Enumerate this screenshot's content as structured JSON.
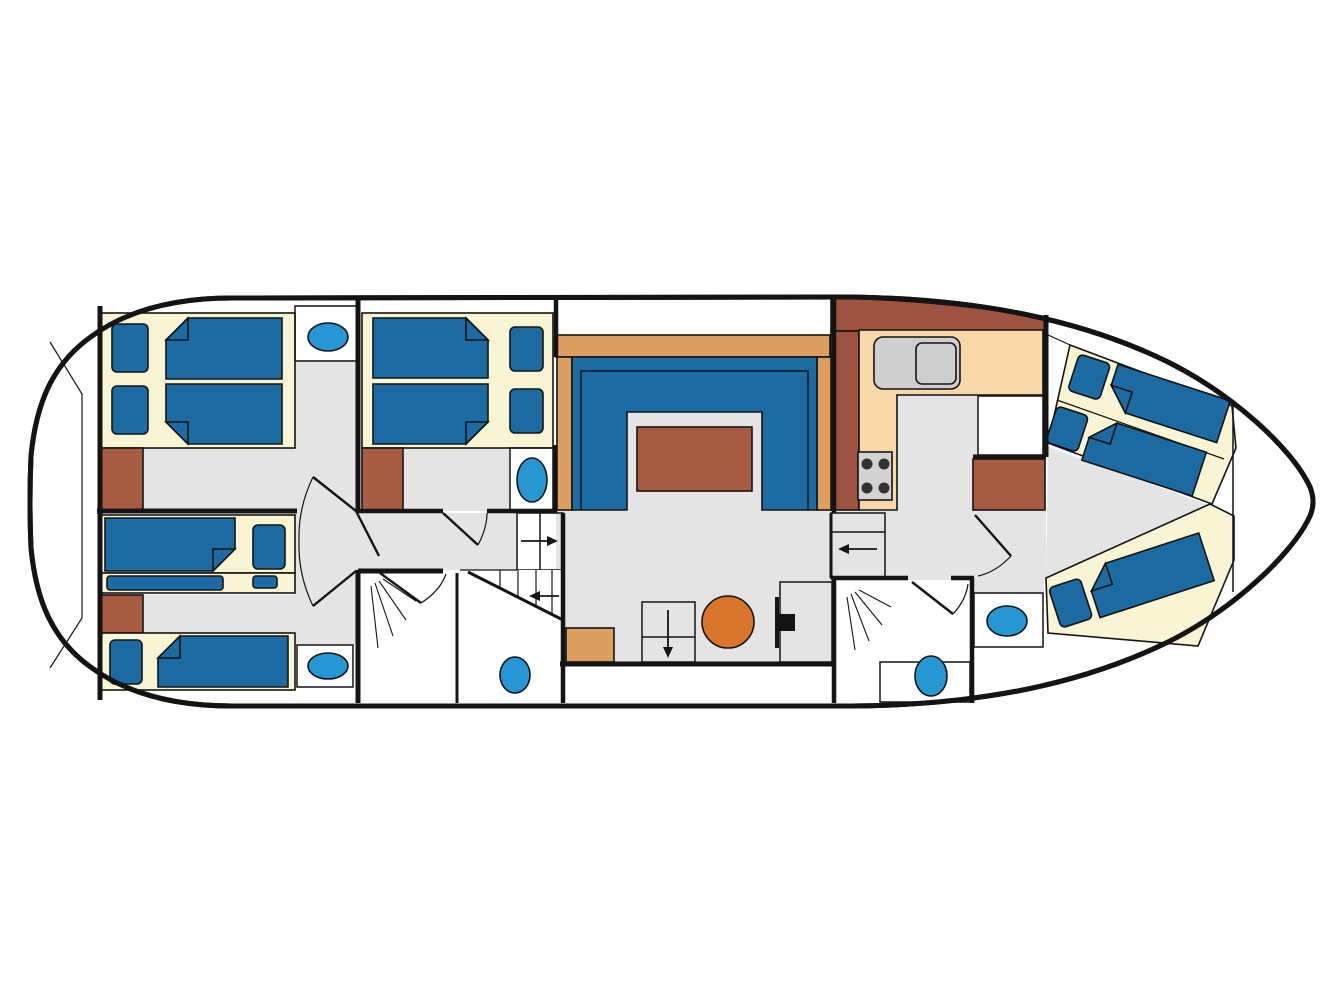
{
  "diagram": {
    "type": "boat-floor-plan",
    "title": "",
    "inventory": {
      "double_berths": 2,
      "single_berths": 5,
      "trundle_berths": 1,
      "toilets": 3,
      "washbasins": 3,
      "showers": 2,
      "wardrobes": 3,
      "staircases": 3,
      "salon_u_sofa": 1,
      "salon_table": 1,
      "round_table": 1,
      "galley_stove_burners": 4,
      "galley_sink": 1,
      "helm_station": 1
    },
    "elements": [
      "hull-outline",
      "aft-cabin-double-bed",
      "mid-cabin-double-bed",
      "aft-cabin-single-bed-with-trundle",
      "aft-cabin-single-bed",
      "bow-cabin-three-berths",
      "salon-u-sofa",
      "salon-table",
      "galley-counter",
      "galley-stove",
      "galley-sink",
      "shower-room-aft",
      "shower-room-fore",
      "wc-toilets",
      "washbasins",
      "companionway-stairs",
      "round-dinette-table",
      "helm-seat",
      "wardrobes",
      "door-swings"
    ]
  },
  "colors": {
    "line": "#141414",
    "floor_gray": "#e4e4e4",
    "cream": "#f9f4d3",
    "bed_blue": "#1c6ba3",
    "fixture_blue": "#2797d4",
    "wood_brown": "#a75c41",
    "wood_brown_dark": "#9e5340",
    "tan": "#dd9f60",
    "peach": "#f8d7a9",
    "table_orange": "#d9752c",
    "sink_gray": "#cfcfcf",
    "stove_gray": "#d2d2d2",
    "burner_dark": "#333333"
  }
}
